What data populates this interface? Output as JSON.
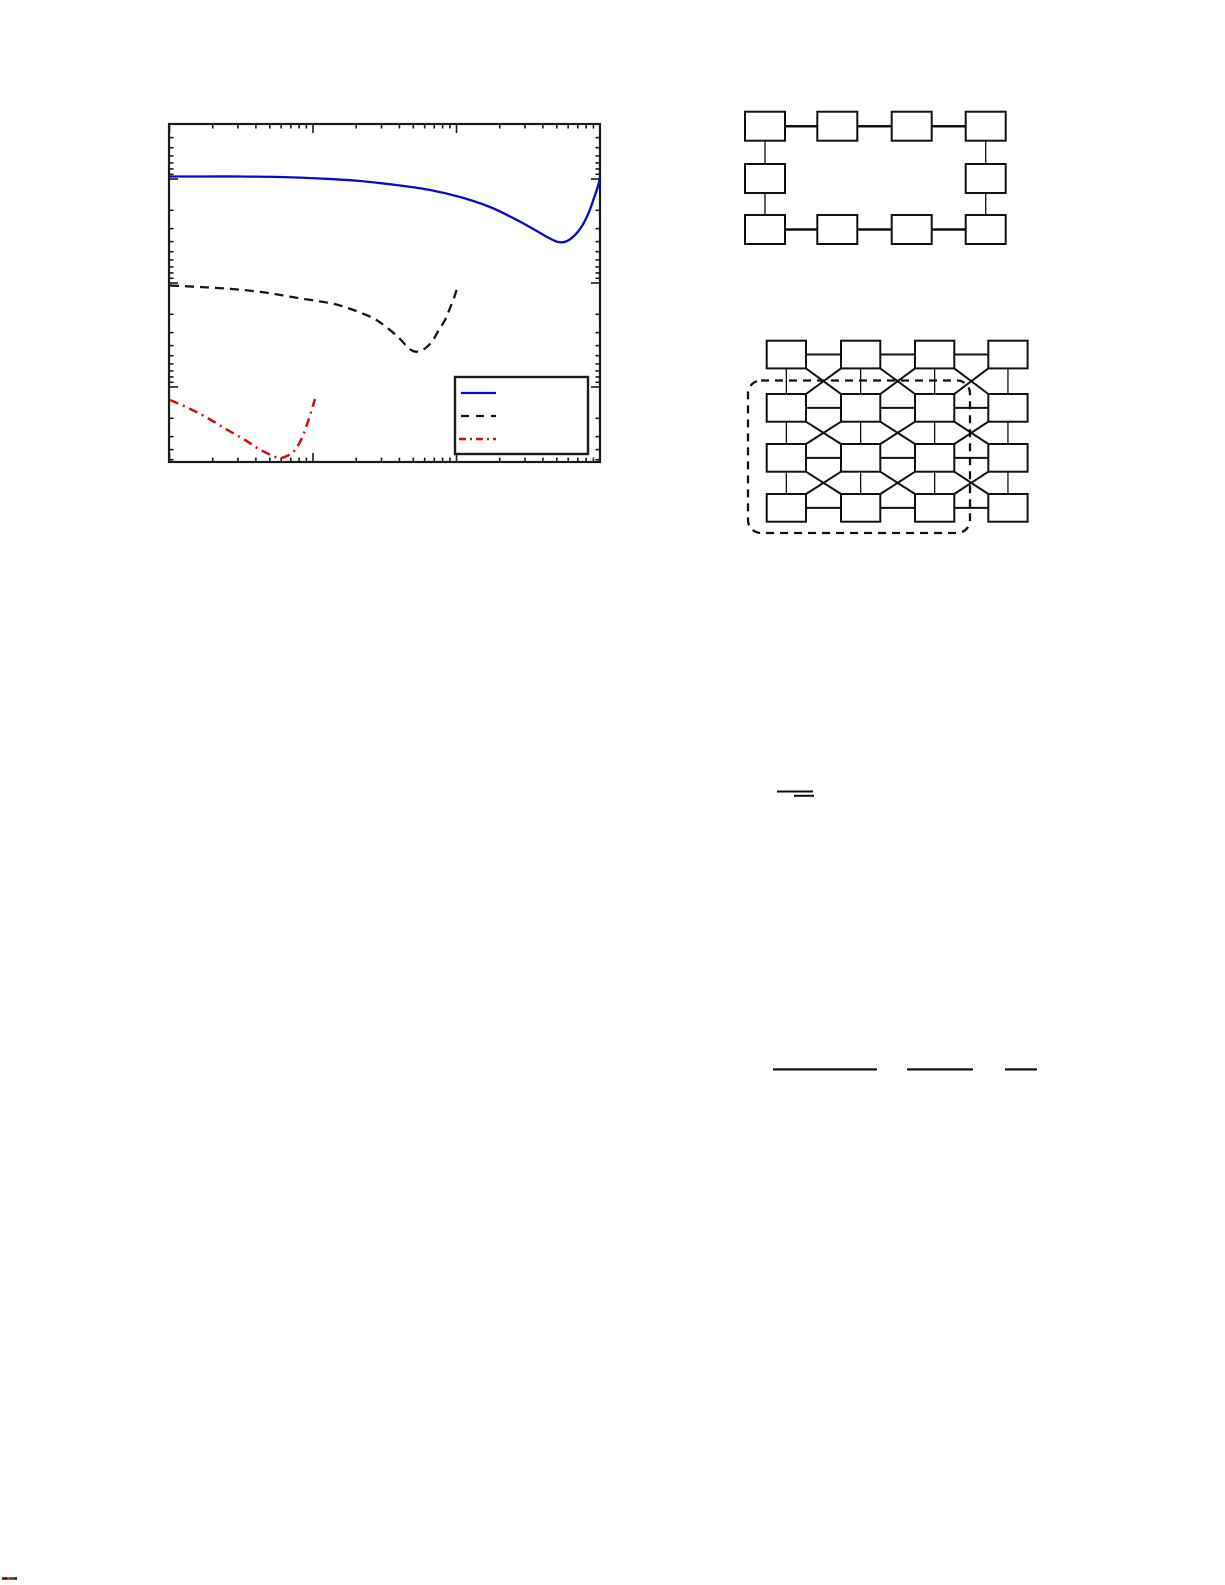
{
  "page": {
    "width": 1225,
    "height": 1585,
    "background": "#ffffff",
    "note": "Scanned/rendered paper page; all body text glyphs absent, only vector figures visible"
  },
  "colors": {
    "axis": "#1a1a1a",
    "box_stroke": "#111111",
    "blue_series": "#0b0bc4",
    "black_series": "#151515",
    "red_series": "#cc1111",
    "dashed_region": "#111111"
  },
  "chart_data": {
    "type": "line",
    "title": "",
    "xlabel": "",
    "ylabel": "",
    "x_scale": "log",
    "y_scale": "log",
    "axis_tick_labels_visible": false,
    "legend_text_visible": false,
    "legend_position": "lower right inside",
    "grid": false,
    "frame_px": {
      "x": 169,
      "y": 124,
      "width": 431,
      "height": 338
    },
    "x_major_ticks_px": [
      169.5,
      313,
      456.5,
      600
    ],
    "y_major_ticks_px": [
      179,
      283,
      387
    ],
    "y_decade_px": 104,
    "series": [
      {
        "name": "blue-solid-curve",
        "style": "solid",
        "color_key": "blue_series",
        "width": 2.3,
        "points_px": [
          [
            170,
            176.5
          ],
          [
            200,
            176.5
          ],
          [
            240,
            176.5
          ],
          [
            280,
            177
          ],
          [
            320,
            178.5
          ],
          [
            360,
            181
          ],
          [
            400,
            185.5
          ],
          [
            430,
            190
          ],
          [
            460,
            197
          ],
          [
            490,
            207
          ],
          [
            515,
            219
          ],
          [
            535,
            230
          ],
          [
            548,
            237.5
          ],
          [
            558,
            242
          ],
          [
            566,
            241.5
          ],
          [
            574,
            236
          ],
          [
            582,
            226
          ],
          [
            589,
            212
          ],
          [
            594,
            198
          ],
          [
            598,
            186
          ],
          [
            600,
            177
          ]
        ]
      },
      {
        "name": "black-dashed-curve",
        "style": "dashed",
        "color_key": "black_series",
        "width": 2.3,
        "dasharray": "9,6",
        "points_px": [
          [
            170,
            285.5
          ],
          [
            200,
            287
          ],
          [
            232,
            289
          ],
          [
            265,
            292.5
          ],
          [
            298,
            298
          ],
          [
            332,
            303.5
          ],
          [
            352,
            309.5
          ],
          [
            372,
            317.5
          ],
          [
            385,
            326
          ],
          [
            398,
            337
          ],
          [
            408,
            347.5
          ],
          [
            413,
            351
          ],
          [
            418,
            351.5
          ],
          [
            425,
            348.5
          ],
          [
            432,
            341.5
          ],
          [
            438,
            331.5
          ],
          [
            445,
            320
          ],
          [
            450,
            308
          ],
          [
            455,
            295
          ],
          [
            458,
            284.5
          ]
        ]
      },
      {
        "name": "red-dashdot-curve",
        "style": "dashdot",
        "color_key": "red_series",
        "width": 2.5,
        "dasharray": "9,5,2,5",
        "points_px": [
          [
            170,
            400
          ],
          [
            185,
            406.5
          ],
          [
            205,
            416.5
          ],
          [
            225,
            428.5
          ],
          [
            245,
            440
          ],
          [
            258,
            448.5
          ],
          [
            272,
            455.5
          ],
          [
            280,
            458
          ],
          [
            288,
            455.5
          ],
          [
            295,
            450
          ],
          [
            302,
            438
          ],
          [
            307,
            424.5
          ],
          [
            312,
            409
          ],
          [
            315,
            399
          ]
        ]
      }
    ],
    "legend": {
      "box_px": {
        "x": 455,
        "y": 377,
        "width": 133,
        "height": 77
      },
      "border_width": 2.4,
      "samples": [
        {
          "series": 0,
          "x1": 461,
          "x2": 496,
          "y": 393
        },
        {
          "series": 1,
          "x1": 461,
          "x2": 496,
          "y": 416
        },
        {
          "series": 2,
          "x1": 459,
          "x2": 496,
          "y": 439
        }
      ]
    }
  },
  "ring_diagram": {
    "description": "10 empty node boxes connected in a ring (4 top, 2 middle sides, 4 bottom)",
    "cols_x": [
      745,
      817.3,
      891.7,
      965.7
    ],
    "rows_y": [
      111.7,
      164,
      215
    ],
    "box_w": 40,
    "box_h": 29,
    "box_stroke_width": 2,
    "h_link_width": 2.5,
    "v_link_width": 1.3
  },
  "mesh_diagram": {
    "description": "4x4 grid of empty node boxes with horizontal, vertical and diagonal (X) links; dashed rounded loop enclosing lower-left 3x3 sub-grid",
    "cols_x": [
      766.7,
      841,
      915,
      988.3
    ],
    "rows_y": [
      340.7,
      394,
      444,
      494
    ],
    "box_w": 39.3,
    "box_h": 27.7,
    "box_stroke_width": 2,
    "h_link_width": 2,
    "v_link_width": 1.3,
    "diag_link_width": 2,
    "dashed_region": {
      "x": 748,
      "y": 380.5,
      "width": 222,
      "height": 152.5,
      "radius": 13,
      "stroke_width": 2.3,
      "dasharray": "8,6"
    }
  },
  "equation_marks": {
    "description": "Residual horizontal rules of equations whose text glyphs are missing",
    "mid_group": [
      {
        "x": 777,
        "y": 790.5,
        "w": 36,
        "h": 2
      },
      {
        "x": 794,
        "y": 794.8,
        "w": 20,
        "h": 2
      }
    ],
    "lower_group": [
      {
        "x": 773,
        "y": 1068.3,
        "w": 104,
        "h": 2.2
      },
      {
        "x": 907,
        "y": 1068.3,
        "w": 66,
        "h": 2.2
      },
      {
        "x": 1005,
        "y": 1068.3,
        "w": 32,
        "h": 2.2
      }
    ]
  },
  "corner_mark": {
    "description": "Tiny multicoloured artifact strip at bottom-left corner",
    "x": 2,
    "y": 1577.2,
    "h": 2.6,
    "segments": [
      {
        "color": "#6b1200",
        "w": 3
      },
      {
        "color": "#181818",
        "w": 2
      },
      {
        "color": "#b53a10",
        "w": 2.5
      },
      {
        "color": "#8c1f00",
        "w": 2
      },
      {
        "color": "#1d5c1d",
        "w": 2.5
      },
      {
        "color": "#103a10",
        "w": 1.5
      },
      {
        "color": "#181818",
        "w": 1.5
      }
    ]
  }
}
